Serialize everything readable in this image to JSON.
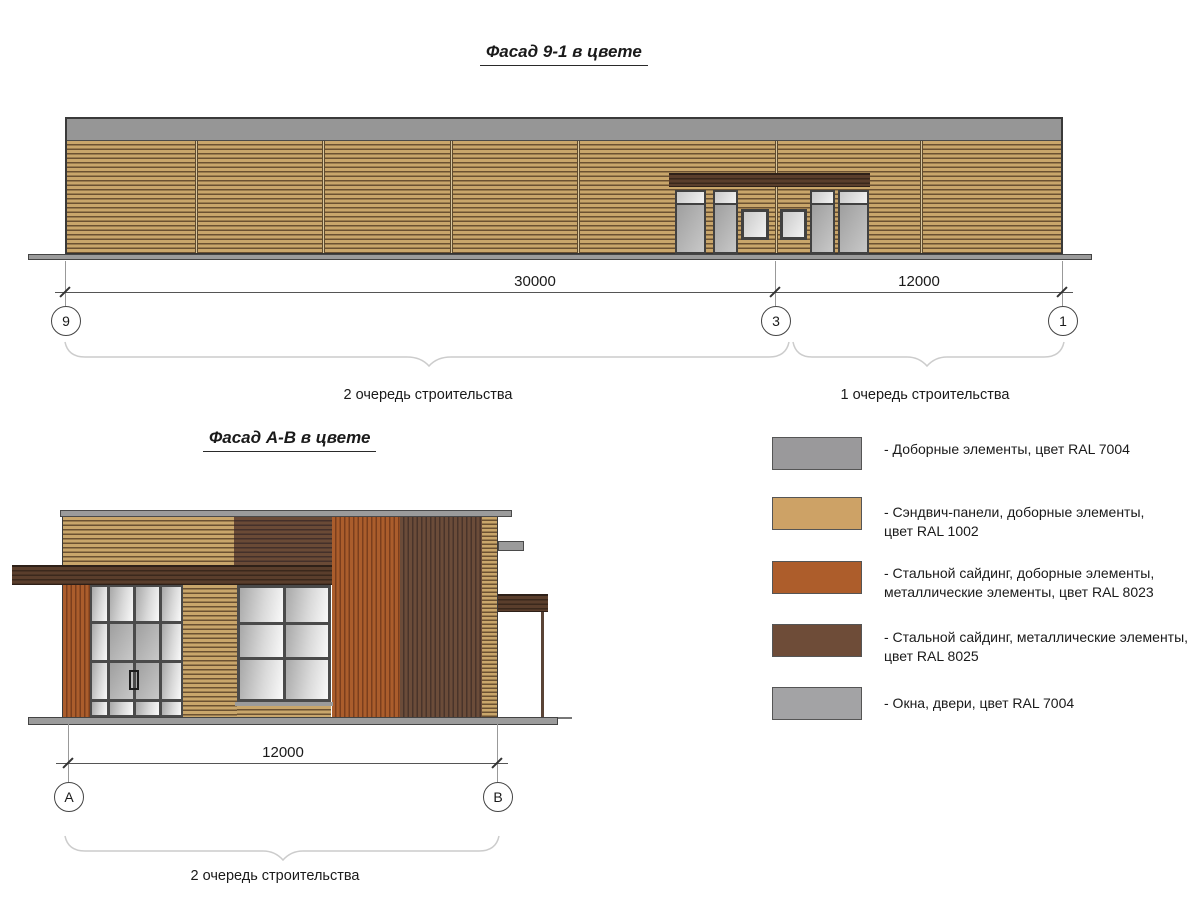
{
  "facade1": {
    "title": "Фасад 9-1 в цвете",
    "dim_span_left": "30000",
    "dim_span_right": "12000",
    "axes": [
      "9",
      "3",
      "1"
    ],
    "phase_left": "2 очередь строительства",
    "phase_right": "1 очередь строительства"
  },
  "facade2": {
    "title": "Фасад А-В в цвете",
    "dim_span": "12000",
    "axes": [
      "А",
      "В"
    ],
    "phase": "2 очередь строительства"
  },
  "legend": {
    "items": [
      {
        "color": "#9a999b",
        "label": "- Доборные элементы, цвет RAL 7004"
      },
      {
        "color": "#cda266",
        "label": "- Сэндвич-панели, доборные элементы,\nцвет RAL 1002"
      },
      {
        "color": "#ad5d2b",
        "label": "- Стальной сайдинг, доборные элементы,\nметаллические элементы, цвет RAL 8023"
      },
      {
        "color": "#6e4c38",
        "label": "- Стальной сайдинг, металлические элементы,\nцвет RAL 8025"
      },
      {
        "color": "#a3a3a5",
        "label": "- Окна, двери, цвет RAL 7004"
      }
    ]
  },
  "colors": {
    "parapet_gray": "#969696",
    "siding_tan": "#c9a66b",
    "siding_orange": "#ab5d2c",
    "siding_dark_brown": "#6b4c39",
    "glass_gray": "#c0c0c0"
  }
}
